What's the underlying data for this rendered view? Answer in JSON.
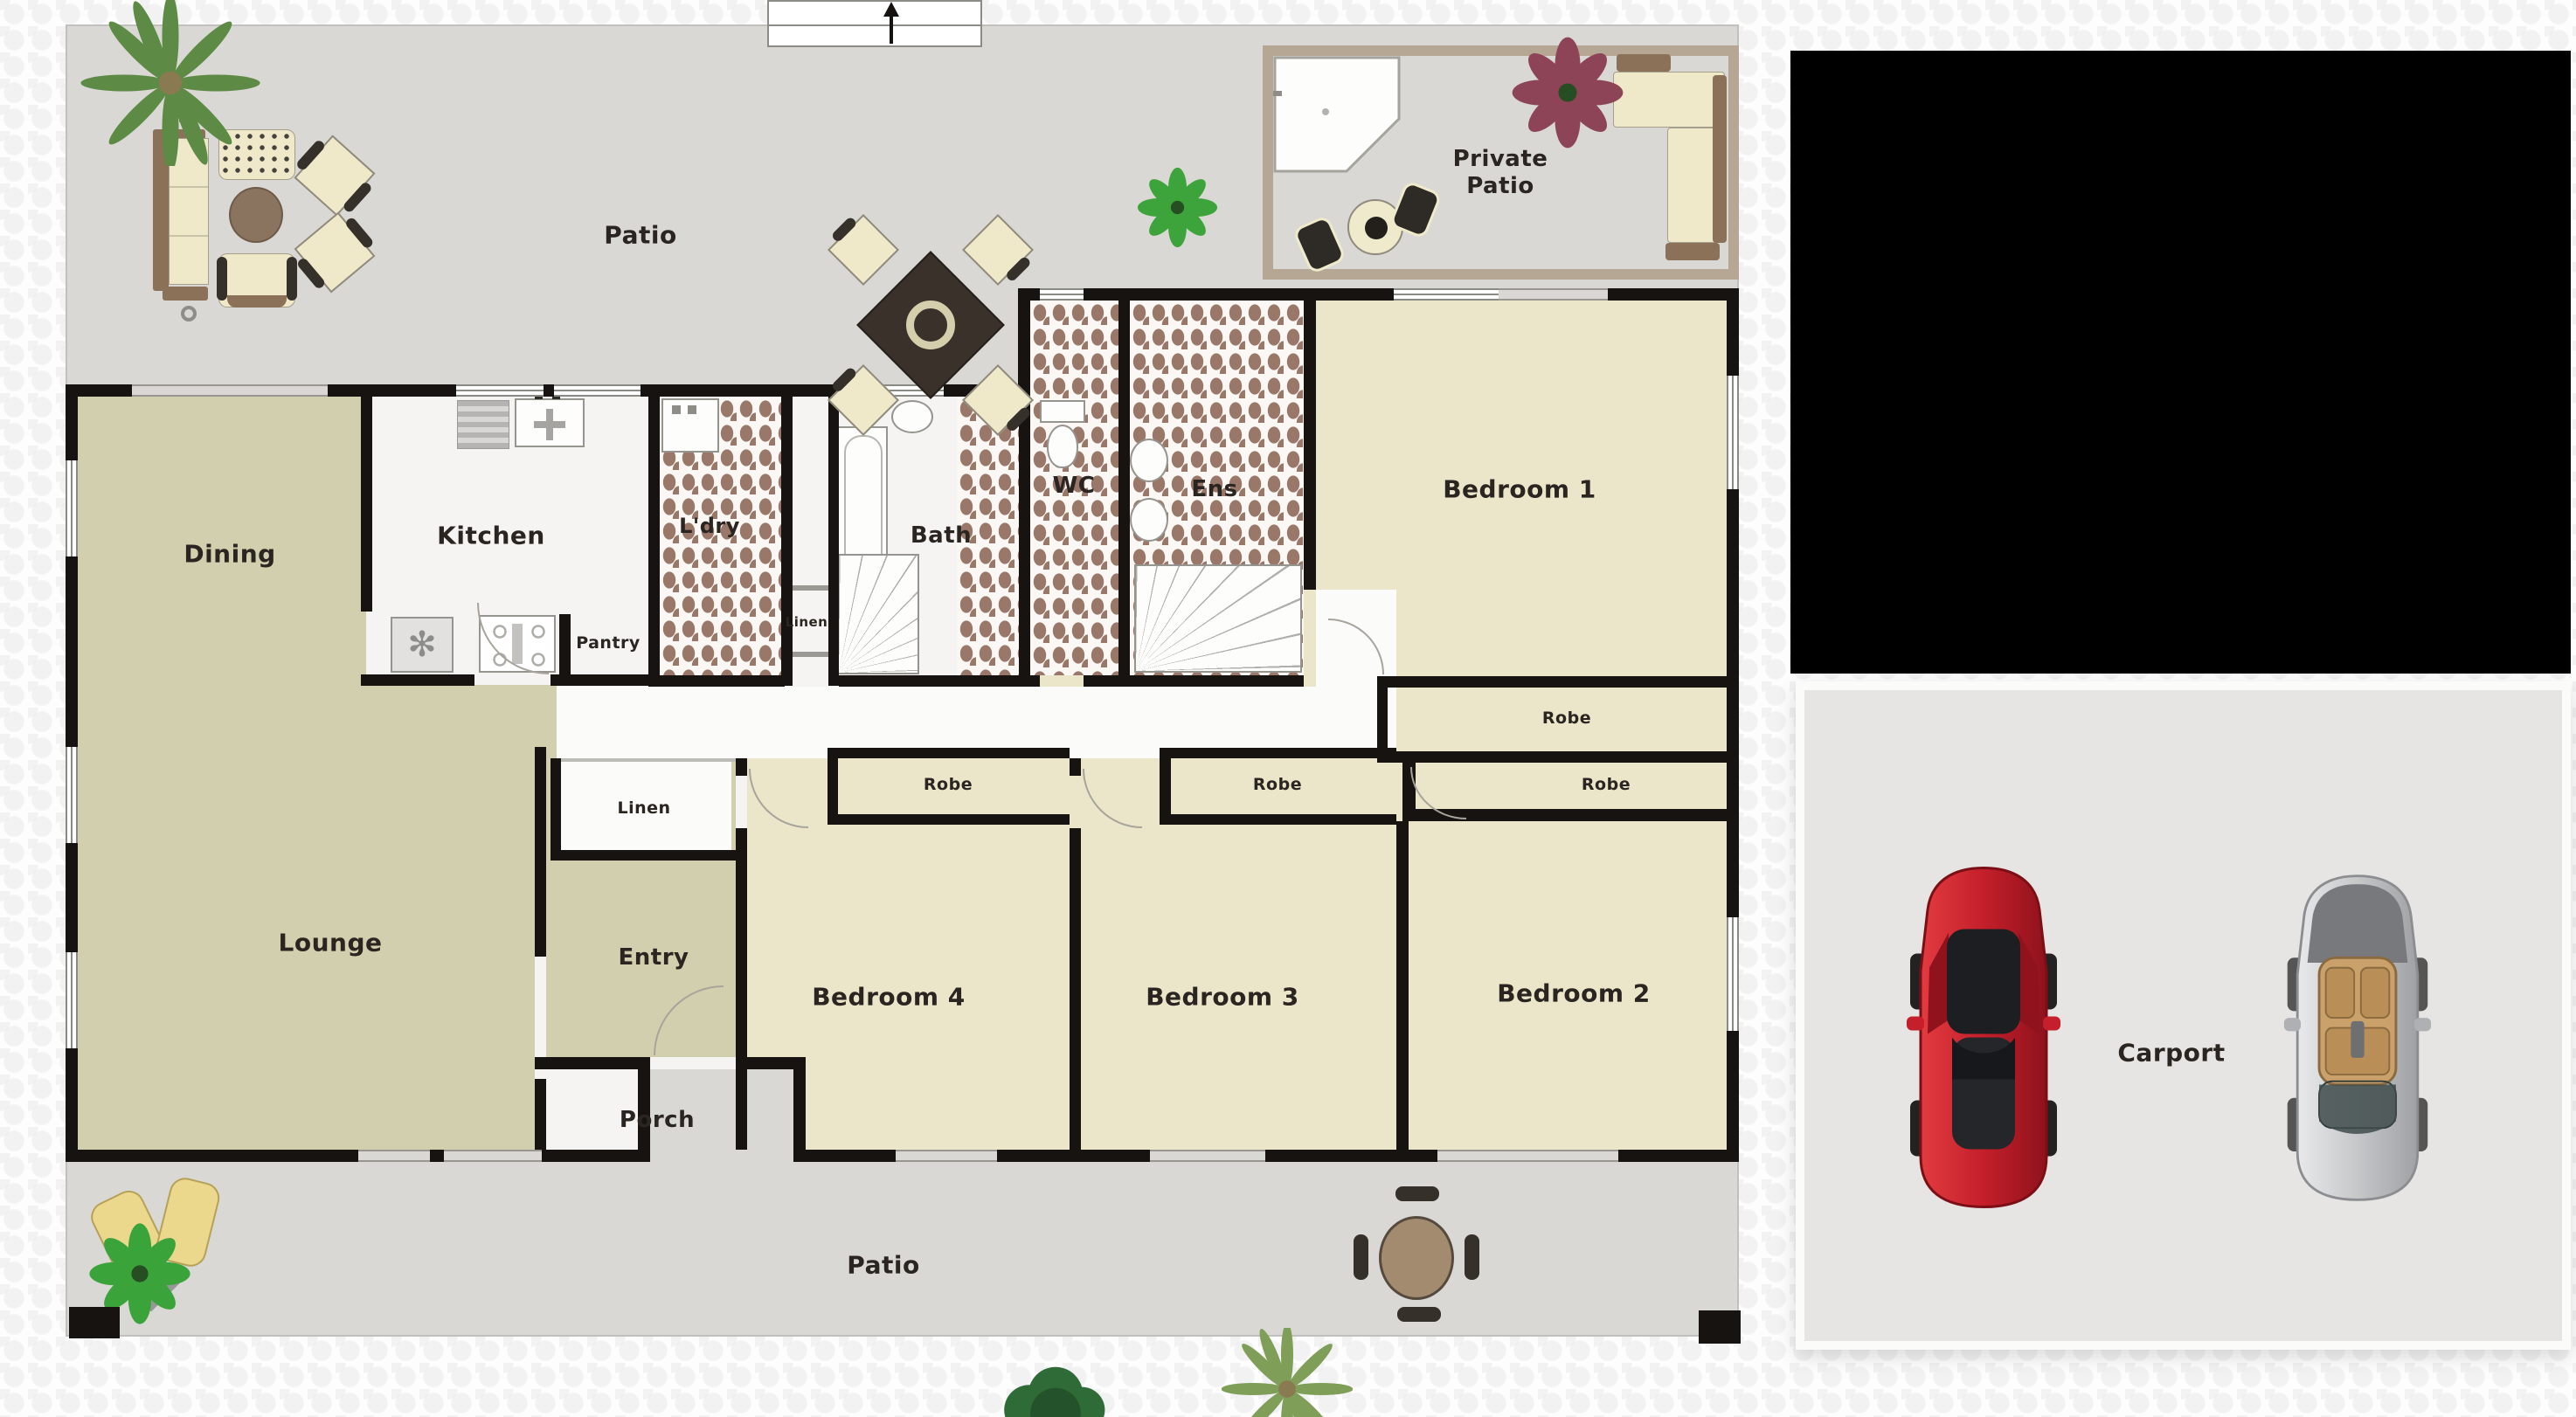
{
  "title": "Residential floor plan with patio, four bedrooms and carport",
  "labels": {
    "patio_top": "Patio",
    "private_patio": "Private Patio",
    "dining": "Dining",
    "kitchen": "Kitchen",
    "pantry": "Pantry",
    "laundry": "L'dry",
    "linen_bath": "Linen",
    "linen_hall": "Linen",
    "bath": "Bath",
    "wc": "WC",
    "ens": "Ens",
    "bedroom1": "Bedroom 1",
    "bedroom2": "Bedroom 2",
    "bedroom3": "Bedroom 3",
    "bedroom4": "Bedroom 4",
    "robe1": "Robe",
    "robe2": "Robe",
    "robe3": "Robe",
    "robe4": "Robe",
    "lounge": "Lounge",
    "entry": "Entry",
    "porch": "Porch",
    "patio_bottom": "Patio",
    "carport": "Carport"
  },
  "colors": {
    "wall": "#161310",
    "patio": "#d9d8d5",
    "khaki": "#d2cfae",
    "cream": "#ebe6c9",
    "tile_brown": "#997869",
    "kitchen_floor": "#f5f4f2",
    "hall_floor": "#fbfbfa",
    "private_border": "#b6a795",
    "carport": "#e6e5e3",
    "redacted": "#000000",
    "car_red": "#c41f2a",
    "car_silver": "#c6c7c9",
    "label_ink": "#2a2520"
  },
  "icons": {
    "north_arrow": "up-arrow",
    "plants": [
      "palm-tree",
      "green-plant",
      "maroon-plant",
      "flower-plant",
      "bush"
    ],
    "vehicles": [
      "red-sports-car-top-view",
      "silver-convertible-top-view"
    ],
    "furniture": [
      "outdoor-sofa-set",
      "square-dining-table-with-chairs",
      "round-patio-table",
      "l-shaped-sofa",
      "sun-loungers",
      "corner-shower",
      "bathtub",
      "toilet",
      "basin",
      "stove",
      "sink",
      "fridge",
      "washing-machine"
    ]
  }
}
